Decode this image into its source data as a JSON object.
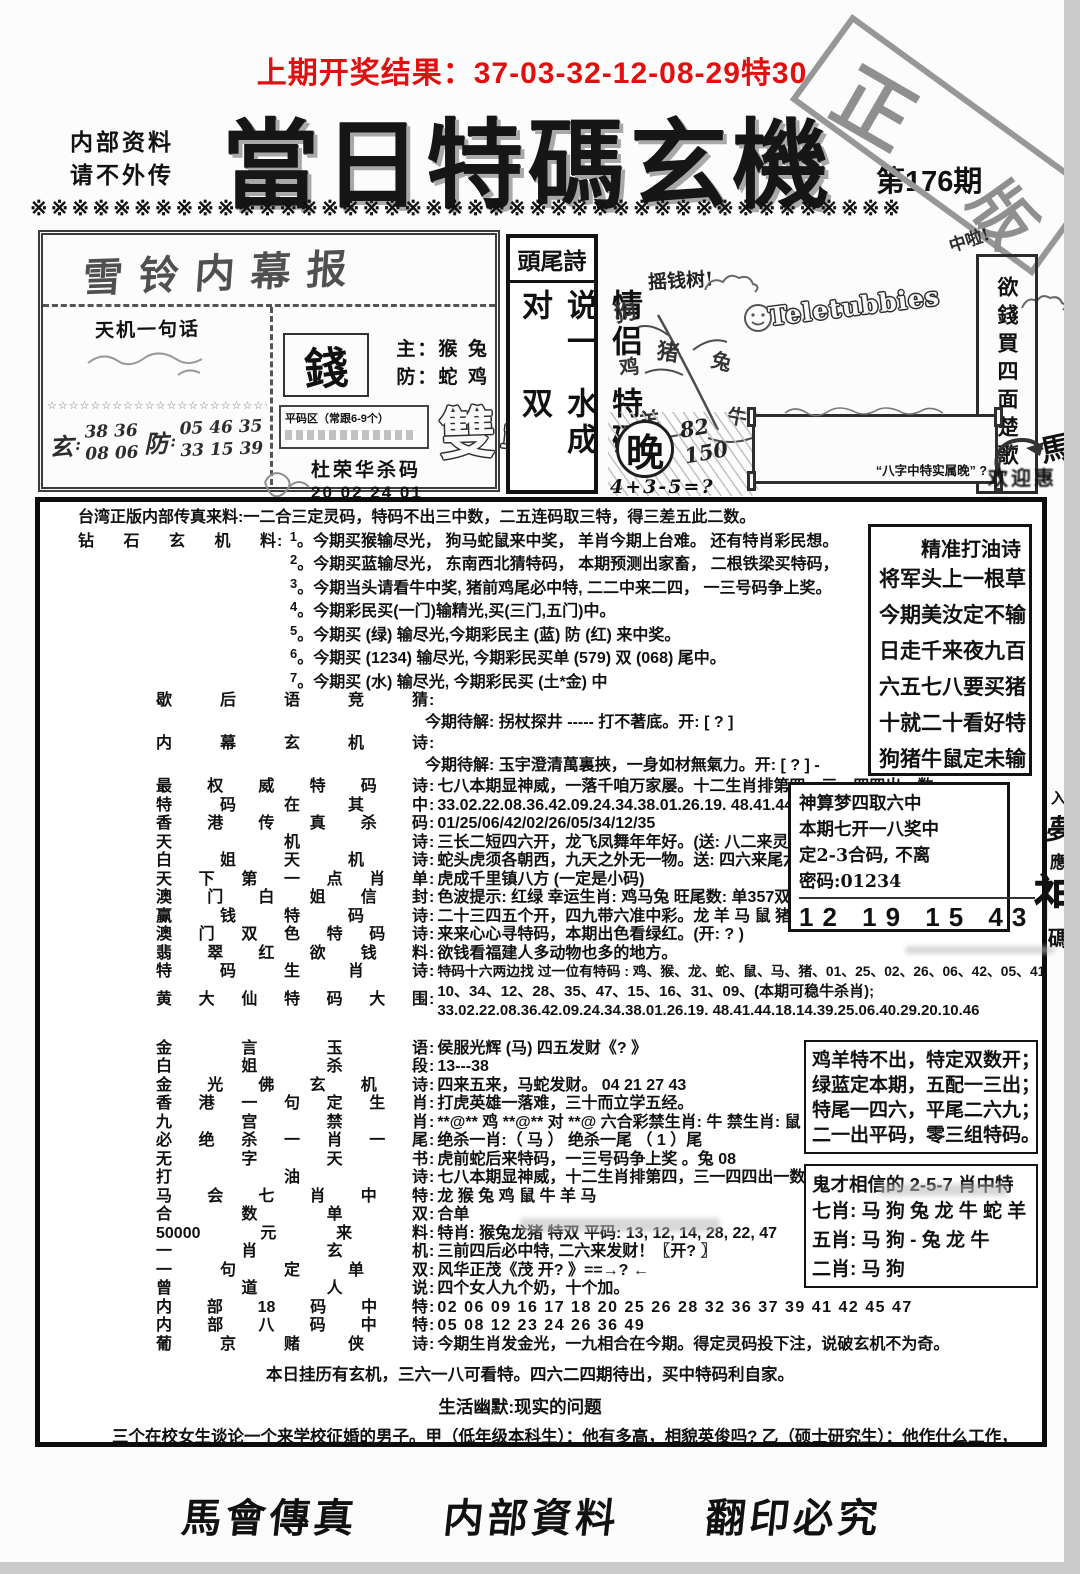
{
  "ui": {
    "colon": ":"
  },
  "header": {
    "prev_result": "上期开奖结果：37-03-32-12-08-29特30",
    "note1": "内部资料",
    "note2": "请不外传",
    "title": "當日特碼玄機",
    "issue": "第176期",
    "stamp_char1": "正",
    "stamp_char2": "版",
    "divider": "※※※※※※※※※※※※※※※※※※※※※※※※※※※※※※※※※※※※※※※※※※",
    "red_color": "#e01010"
  },
  "hand": {
    "left_box": {
      "title": "雪铃内幕报",
      "tianji": "天机一句话",
      "stars": "☆☆☆☆☆☆☆☆☆☆☆☆☆☆☆☆☆☆☆☆☆☆",
      "xuan_char": "玄",
      "xuan_line1": "38  36",
      "xuan_line2": "08  06",
      "fang_char": "防",
      "fang_line1": "05  46  35",
      "fang_line2": "33  15  39",
      "money_char": "錢",
      "zhu_line": "主：猴 兔",
      "fang_line": "防：蛇 鸡",
      "pingma_label": "平码区（常跟6-9个）",
      "shuang_char": "雙",
      "dan_char": "單",
      "du_title": "杜荣华杀码",
      "du_rows": [
        "20   02   24   01",
        "16   12   37   34",
        "45   49   48   18"
      ]
    },
    "touwei": {
      "title": "頭尾詩",
      "col_right": "情侣说一对",
      "col_left": "特码水成双"
    },
    "doodle": {
      "tree_label": "摇钱树!",
      "tree_chars": [
        "狗",
        "猪",
        "鸡",
        "兔",
        "羊",
        "牛"
      ],
      "bubble_text": "Teletubbies",
      "zhongla": "中啦!",
      "right_vertical": "欲錢買四面楚歌",
      "wan_char": "晚",
      "wan_num1": "82",
      "wan_num2": "150",
      "wan_formula": "4+3-5=?",
      "frame_caption": "“八字中特实属晚” ?",
      "horse_char": "馬",
      "welcome": "欢迎惠顾"
    }
  },
  "content": {
    "intro": "台湾正版内部传真来料:一二合三定灵码，特码不出三中数，二五连码取三特，得三差五此二数。",
    "diamond": {
      "label": "钻石玄机料",
      "items": [
        {
          "n": "1",
          "t": "。今期买猴输尽光， 狗马蛇鼠来中奖， 羊肖今期上台难。 还有特肖彩民想。"
        },
        {
          "n": "2",
          "t": "。今期买蓝输尽光， 东南西北猜特码， 本期预测出家畜， 二根铁梁买特码，"
        },
        {
          "n": "3",
          "t": "。今期当头请看牛中奖, 猪前鸡尾必中特, 二二中来二四， 一三号码争上奖。"
        },
        {
          "n": "4",
          "t": "。今期彩民买(一门)输精光,买(三门,五门)中。"
        },
        {
          "n": "5",
          "t": "。今期买 (绿) 输尽光,今期彩民主 (蓝) 防 (红) 来中奖。"
        },
        {
          "n": "6",
          "t": "。今期买 (1234) 输尽光, 今期彩民买单 (579) 双 (068) 尾中。"
        },
        {
          "n": "7",
          "t": "。今期买 (水) 输尽光, 今期彩民买 (土*金) 中"
        }
      ]
    },
    "riddle": {
      "label": "歇后语竞猜",
      "solve": "今期待解: 拐杖探井 ----- 打不著底。开: [ ? ]"
    },
    "inside": {
      "label": "内幕玄机诗",
      "solve": "今期待解: 玉宇澄清萬裏挾，一身如材無氣力。开: [ ? ] -"
    },
    "lines": [
      {
        "l": "最权威特码诗",
        "t": "七八本期显神威，一落千咱万家屡。十二生肖排第四，三一四四出一数。"
      },
      {
        "l": "特码在其中",
        "t": "33.02.22.08.36.42.09.24.34.38.01.26.19. 48.41.44.18.14.39.10.46"
      },
      {
        "l": "香港传真杀码",
        "t": "01/25/06/42/02/26/05/34/12/35"
      },
      {
        "l": "天机诗",
        "t": "三长二短四六开，龙飞凤舞年年好。(送: 八二来灵码)"
      },
      {
        "l": "白姐天机诗",
        "t": "蛇头虎须各朝西，九天之外无一物。送: 四六来尾六"
      },
      {
        "l": "天下第一点肖单",
        "t": "虎成千里镇八方 (一定是小码)"
      },
      {
        "l": "澳门白姐信封",
        "t": "色波提示: 红绿 幸运生肖: 鸡马兔 旺尾数: 单357双268"
      },
      {
        "l": "赢钱特码诗",
        "t": "二十三四五个开，四九带六准中彩。龙 羊 马 鼠 猪"
      },
      {
        "l": "澳门双色特码诗",
        "t": "来来心心寻特码，本期出色看绿红。(开: ? )"
      },
      {
        "l": "翡翠红欲钱料",
        "t": "欲钱看福建人多动物也多的地方。"
      },
      {
        "l": "特码生肖诗",
        "t": "特码十六两边找 过一位有特码 : 鸡、猴、龙、蛇、鼠、马、猪、01、25、02、26、06、42、05、41、"
      }
    ],
    "huang": {
      "l": "黄大仙特码大围",
      "t1": "10、34、12、28、35、47、15、16、31、09、(本期可稳牛杀肖);",
      "t2": "33.02.22.08.36.42.09.24.34.38.01.26.19. 48.41.44.18.14.39.25.06.40.29.20.10.46"
    },
    "lines2": [
      {
        "l": "金言玉语",
        "t": "侯服光辉 (马) 四五发财《? 》"
      },
      {
        "l": "白姐杀段",
        "t": "13---38"
      },
      {
        "l": "金光佛玄机诗",
        "t": "四来五来，马蛇发财。  04 21 27 43"
      },
      {
        "l": "香港一句定生肖",
        "t": "打虎英雄一落难，三十而立学五经。"
      },
      {
        "l": "九宫禁肖",
        "t": "**@** 鸡 **@** 对 **@ 六合彩禁生肖: 牛  禁生肖: 鼠"
      },
      {
        "l": "必绝杀一肖一尾",
        "t": "绝杀一肖:（ 马  ） 绝杀一尾 （ 1 ）尾"
      },
      {
        "l": "无字天书",
        "t": "虎前蛇后来特码，一三号码争上奖 。兔 08"
      },
      {
        "l": "打油诗",
        "t": "七八本期显神威，十二生肖排第四，三一四四出一数( 提供: 牛兔鼠虎 )"
      },
      {
        "l": "马会七肖中特",
        "t": "龙 猴 兔 鸡 鼠 牛 羊 马"
      },
      {
        "l": "合数单双",
        "t": "合单"
      },
      {
        "l": "50000元来料",
        "t": "特肖: 猴兔龙猪  特双  平码: 13, 12, 14, 28, 22, 47"
      },
      {
        "l": "一肖玄机",
        "t": "三前四后必中特, 二六来发财！〖开? 〗"
      },
      {
        "l": "一句定单双",
        "t": "风华正茂《茂 开? 》==→?  ←"
      },
      {
        "l": "曾道人说",
        "t": "四个女人九个奶，十个加。"
      },
      {
        "l": "内部18码中特",
        "t": "02 06 09 16 17 18 20 25 26 28 32 36 37 39 41 42 45 47"
      },
      {
        "l": "内部八码中特",
        "t": "05 08 12 23 24 26 36 49"
      },
      {
        "l": "葡京赌侠诗",
        "t": "今期生肖发金光，一九相合在今期。得定灵码投下注，说破玄机不为奇。"
      }
    ],
    "daily_center": "本日挂历有玄机，三六一八可看特。四六二四期待出，买中特码利自家。",
    "humor_title": "生活幽默:现实的问题",
    "humor_para": "三个在校女生谈论一个来学校征婚的男子。甲（低年级本科生）：他有多高，相貌英俊吗? 乙（硕士研究生）：他作什么工作，月薪几多? 丙（博士研究生）：他在哪！！"
  },
  "side": {
    "jingzhun": {
      "title": "精准打油诗",
      "lines": [
        "将军头上一根草",
        "今期美汝定不输",
        "日走千来夜九百",
        "六五七八要买猪",
        "十就二十看好特",
        "狗猪牛鼠定未输"
      ]
    },
    "shensuan": {
      "line1": "神算梦四取六中",
      "line2": "本期七开一八奖中",
      "line3": "定2-3合码, 不离",
      "pwd": "密码:01234",
      "numbers": "12  19  15  43",
      "vchars": [
        "入",
        "夢",
        "應",
        "神",
        "碼"
      ]
    },
    "jiyang": {
      "lines": [
        "鸡羊特不出，特定双数开；",
        "绿蓝定本期，五配一三出；",
        "特尾一四六，平尾二六九；",
        "二一出平码，零三组特码。"
      ]
    },
    "guicai": {
      "title": "鬼才相信的 2-5-7 肖中特",
      "lines": [
        "七肖: 马 狗 兔 龙 牛 蛇 羊",
        "五肖: 马 狗 - 兔 龙 牛",
        "二肖: 马 狗"
      ]
    }
  },
  "footer": {
    "items": [
      "馬會傳真",
      "内部資料",
      "翻印必究"
    ]
  }
}
